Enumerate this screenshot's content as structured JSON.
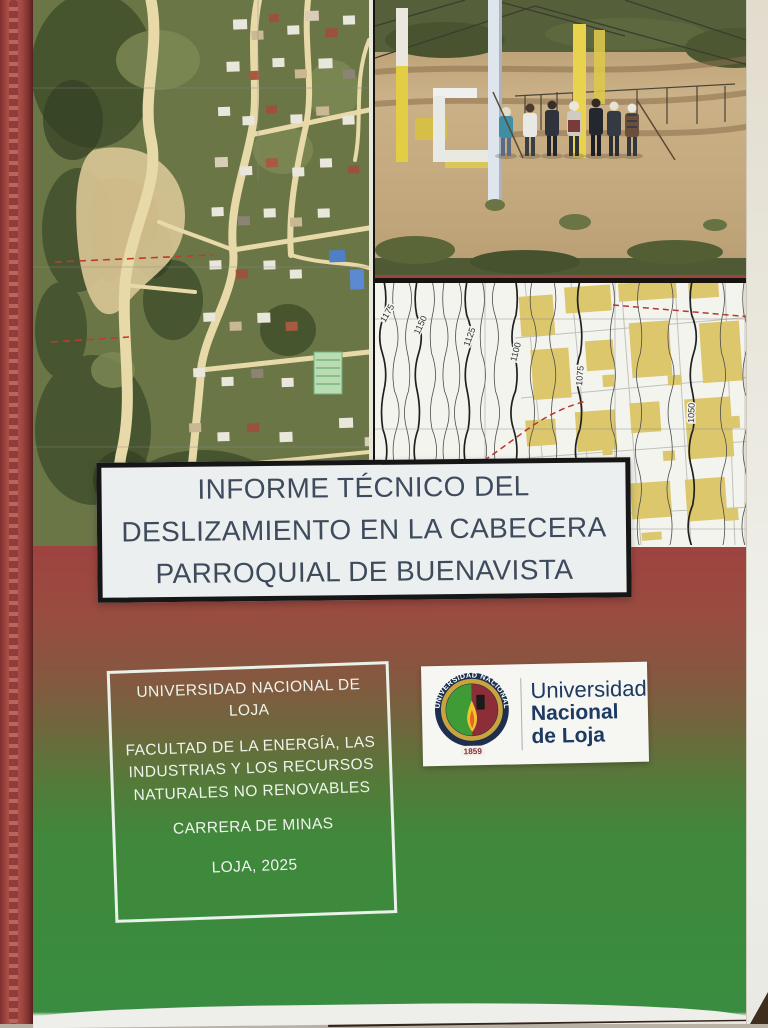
{
  "cover": {
    "title_lines": [
      "INFORME TÉCNICO DEL",
      "DESLIZAMIENTO EN LA CABECERA",
      "PARROQUIAL DE BUENAVISTA"
    ],
    "institution_box": {
      "university": "UNIVERSIDAD NACIONAL DE LOJA",
      "faculty": "FACULTAD DE LA ENERGÍA, LAS INDUSTRIAS Y LOS RECURSOS NATURALES NO RENOVABLES",
      "career": "CARRERA DE MINAS",
      "city_year": "LOJA, 2025"
    },
    "logo": {
      "seal_ring_text": "UNIVERSIDAD NACIONAL DE LOJA",
      "seal_year": "1859",
      "wordmark_line1": "Universidad",
      "wordmark_line2": "Nacional",
      "wordmark_line3": "de Loja"
    },
    "map": {
      "contour_labels": [
        "1175",
        "1150",
        "1125",
        "1100",
        "1075",
        "1050"
      ]
    },
    "colors": {
      "binder_red": "#a84c46",
      "gradient_top_red": "#9e4340",
      "gradient_bottom_green": "#3a8d40",
      "title_text": "#3e4b5c",
      "map_building_yellow": "#dcc76d",
      "map_fault_red": "#b5392e",
      "logo_navy": "#1c3a62",
      "institution_text": "#eef4ec"
    }
  }
}
